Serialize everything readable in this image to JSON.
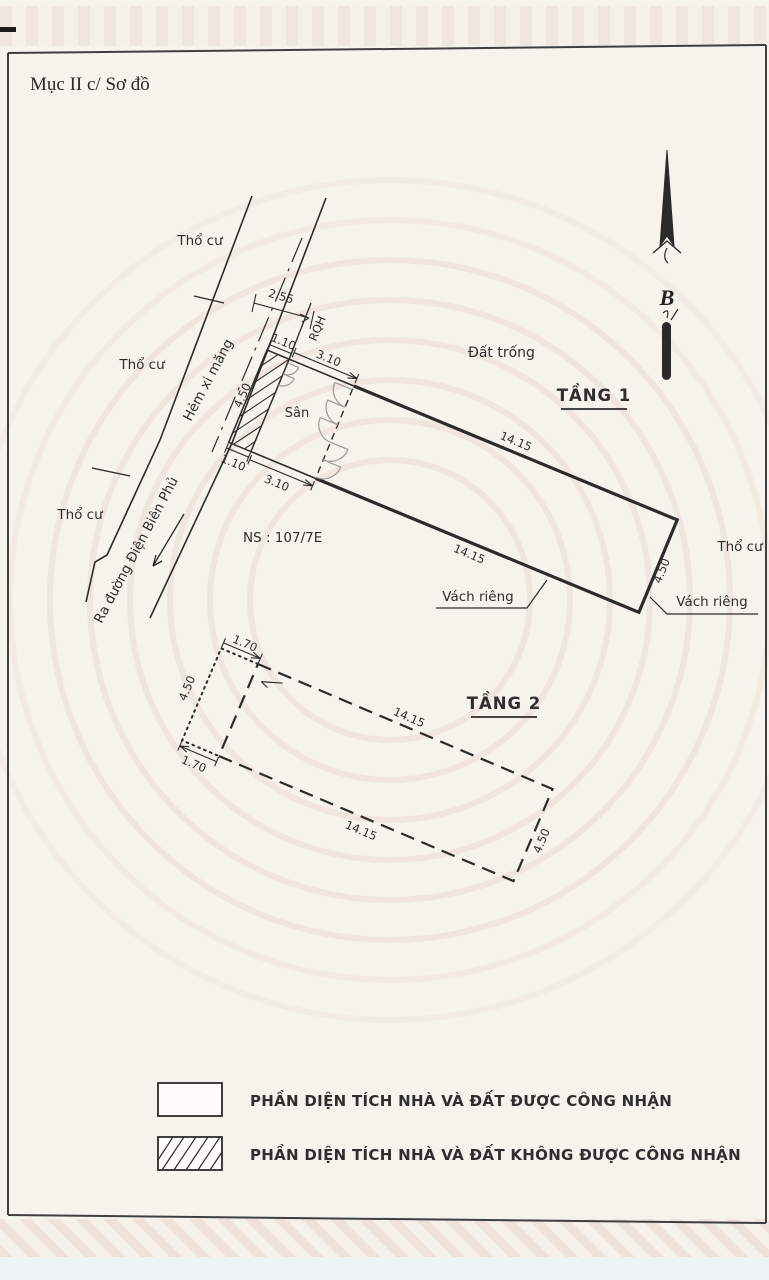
{
  "page": {
    "section_title": "Mục II c/ Sơ đồ"
  },
  "compass": {
    "north_label": "B"
  },
  "surroundings": {
    "parcel_label_1": "Thổ cư",
    "parcel_label_2": "Thổ cư",
    "parcel_label_3": "Thổ cư",
    "parcel_label_right": "Thổ cư",
    "alley_label": "Hẻm xi măng",
    "road_exit_label": "Ra đường Điện Biên Phủ",
    "vacant_label": "Đất trống",
    "house_number": "NS : 107/7E",
    "planning_line_label": "RQH",
    "planning_setback": "2.55"
  },
  "floor1": {
    "title": "TẦNG 1",
    "yard_label": "Sân",
    "wall_label_left": "Vách riêng",
    "wall_label_right": "Vách riêng",
    "dims": {
      "strip_width_top": "1.10",
      "strip_width_bottom": "1.10",
      "yard_depth_top": "3.10",
      "yard_depth_bottom": "3.10",
      "house_length_top": "14.15",
      "house_length_bottom": "14.15",
      "house_width_right": "4.50",
      "frontage_width": "4.50"
    }
  },
  "floor2": {
    "title": "TẦNG 2",
    "dims": {
      "offset_top": "1.70",
      "offset_bottom": "1.70",
      "width_left": "4.50",
      "length_top": "14.15",
      "length_bottom": "14.15",
      "width_right": "4.50"
    }
  },
  "legend": {
    "recognized_label": "PHẦN DIỆN TÍCH NHÀ VÀ ĐẤT ĐƯỢC CÔNG NHẬN",
    "unrecognized_label": "PHẦN DIỆN TÍCH NHÀ VÀ ĐẤT KHÔNG ĐƯỢC CÔNG NHẬN"
  }
}
